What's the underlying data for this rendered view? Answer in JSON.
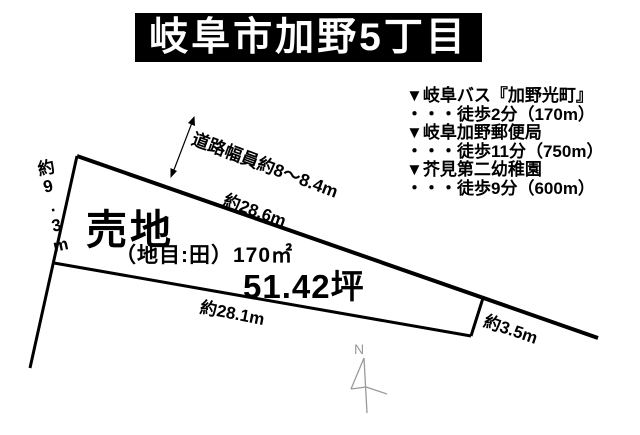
{
  "title": "岐阜市加野5丁目",
  "parcel": {
    "sale_label": "売地",
    "land_category": "（地目:田）170㎡",
    "area_tsubo": "51.42坪",
    "dimensions": {
      "top_edge": "約28.6m",
      "bottom_edge": "約28.1m",
      "left_edge": "約9.3m",
      "right_edge": "約3.5m"
    },
    "road_width": "道路幅員約8～8.4m"
  },
  "access": {
    "items": [
      {
        "name": "▼岐阜バス『加野光町』",
        "walk": "・・・徒歩2分（170m）"
      },
      {
        "name": "▼岐阜加野郵便局",
        "walk": "・・・徒歩11分（750m）"
      },
      {
        "name": "▼芥見第二幼稚園",
        "walk": "・・・徒歩9分（600m）"
      }
    ]
  },
  "compass": {
    "north_label": "N"
  },
  "colors": {
    "ink": "#000000",
    "title_bg": "#000000",
    "title_fg": "#ffffff",
    "background": "#ffffff",
    "compass": "#9a9a9a"
  }
}
